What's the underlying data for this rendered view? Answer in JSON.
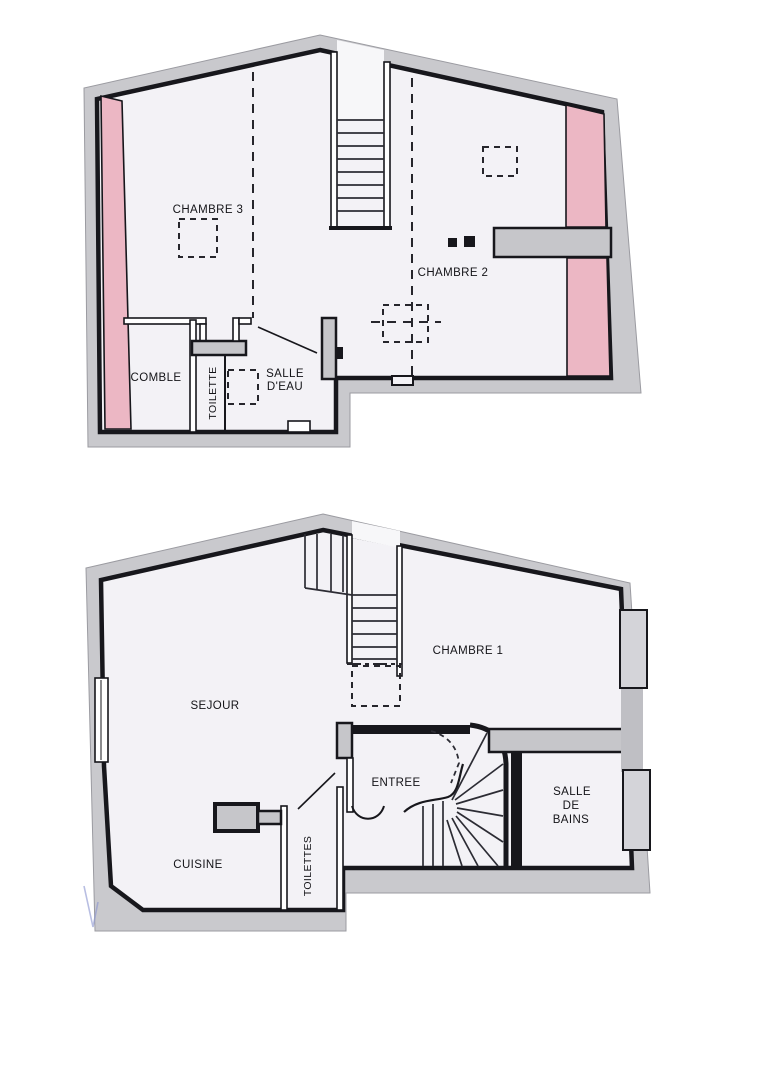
{
  "colors": {
    "wall_outline": "#17171c",
    "wall_band_grey": "#c9c9cd",
    "floor": "#f3f2f6",
    "low_ceiling_pink": "#ecb7c4",
    "grey_wall_fill": "#c6c6ca",
    "window_fill": "#d4d4d9",
    "pen_mark_blue": "#8893cf"
  },
  "plans": {
    "upper": {
      "labels": {
        "chambre3": "CHAMBRE 3",
        "chambre2": "CHAMBRE 2",
        "comble": "COMBLE",
        "toilette": "TOILETTE",
        "salle_eau_line1": "SALLE",
        "salle_eau_line2": "D'EAU"
      }
    },
    "lower": {
      "labels": {
        "sejour": "SEJOUR",
        "chambre1": "CHAMBRE 1",
        "entree": "ENTREE",
        "cuisine": "CUISINE",
        "toilettes": "TOILETTES",
        "salle_bains_line1": "SALLE",
        "salle_bains_line2": "DE",
        "salle_bains_line3": "BAINS"
      }
    }
  }
}
